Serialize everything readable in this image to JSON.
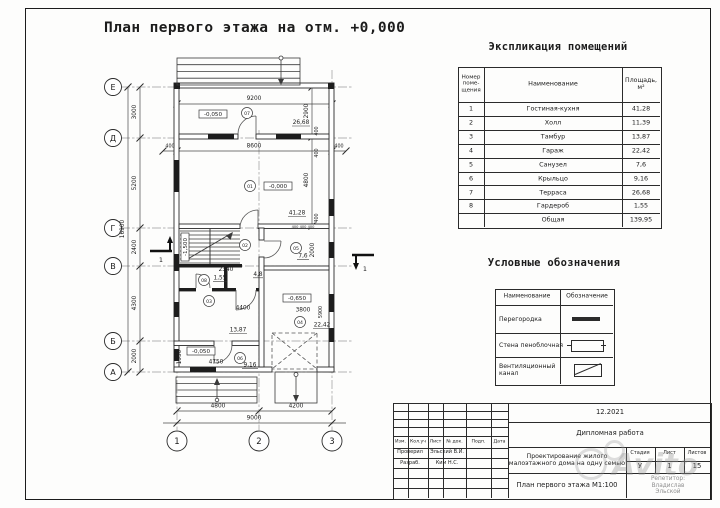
{
  "page": {
    "title": "План первого этажа на отм. +0,000"
  },
  "schedule": {
    "title": "Экспликация помещений",
    "col_num": "Номер\nпоме-\nщения",
    "col_name": "Наименование",
    "col_area": "Площадь,\nм²",
    "rows": [
      {
        "n": "1",
        "name": "Гостиная-кухня",
        "area": "41,28"
      },
      {
        "n": "2",
        "name": "Холл",
        "area": "11,39"
      },
      {
        "n": "3",
        "name": "Тамбур",
        "area": "13,87"
      },
      {
        "n": "4",
        "name": "Гараж",
        "area": "22,42"
      },
      {
        "n": "5",
        "name": "Санузел",
        "area": "7,6"
      },
      {
        "n": "6",
        "name": "Крыльцо",
        "area": "9,16"
      },
      {
        "n": "7",
        "name": "Терраса",
        "area": "26,68"
      },
      {
        "n": "8",
        "name": "Гардероб",
        "area": "1,55"
      },
      {
        "n": "",
        "name": "Общая",
        "area": "139,95"
      }
    ]
  },
  "legend": {
    "title": "Условные обозначения",
    "col_name": "Наименование",
    "col_sym": "Обозначение",
    "row1": "Перегородка",
    "row2": "Стена пеноблочная",
    "row3": "Вентиляционный\nканал"
  },
  "stamp": {
    "date": "12.2021",
    "work": "Дипломная работа",
    "project": "Проектирование жилого\nмалоэтажного дома на одну семью",
    "drawing": "План первого этажа М1:100",
    "stage_label": "Стадия",
    "sheet_label": "Лист",
    "sheets_label": "Листов",
    "stage": "У",
    "sheet_no": "1",
    "sheets_total": "15",
    "col_izm": "Изм.",
    "col_kol": "Кол.уч",
    "col_list": "Лист",
    "col_doc": "№ док.",
    "col_podp": "Подп.",
    "col_data": "Дата",
    "checked_label": "Проверил",
    "checked": "Эльский В.И.",
    "developed_label": "Разраб.",
    "developed": "Ким Н.С.",
    "tutor": "Репетитор: Владислав\nЭльской",
    "watermark": "Avito"
  },
  "plan": {
    "axes": {
      "e": "Е",
      "d": "Д",
      "g": "Г",
      "v": "В",
      "b": "Б",
      "a": "А",
      "c1": "1",
      "c2": "2",
      "c3": "3"
    },
    "dims": {
      "v1": "3000",
      "v2": "5200",
      "v3": "2400",
      "v4": "4300",
      "v5": "2000",
      "vtotal": "16900",
      "h_top": "9200",
      "h_mid": "8600",
      "h400l": "400",
      "h400r": "400",
      "hb1": "4800",
      "hb2": "4200",
      "hbtotal": "9000",
      "r2900": "2900",
      "r4800": "4800",
      "r400a": "400",
      "r400b": "400",
      "r400c": "400",
      "stair_w": "2340",
      "cor": "4,8",
      "hall_w": "4400",
      "gar_w": "3800",
      "wc_h": "2000",
      "gar_h": "5900",
      "porch_h": "1950",
      "porch_w": "4750",
      "micro": "400 400 400"
    },
    "levels": {
      "terrace": "-0,050",
      "living": "-0,000",
      "stair": "-1,500",
      "garage": "-0,650",
      "porch": "-0,050"
    },
    "areas": {
      "terrace": "26,68",
      "living": "41,28",
      "wc": "7,6",
      "ward": "1,55",
      "tambur": "13,87",
      "garage": "22,42",
      "porch": "9,16"
    },
    "marks": {
      "terrace": "07",
      "living": "01",
      "hall": "02",
      "tambur": "03",
      "garage": "04",
      "wc": "05",
      "porch": "06",
      "ward": "08"
    },
    "section": "1"
  }
}
